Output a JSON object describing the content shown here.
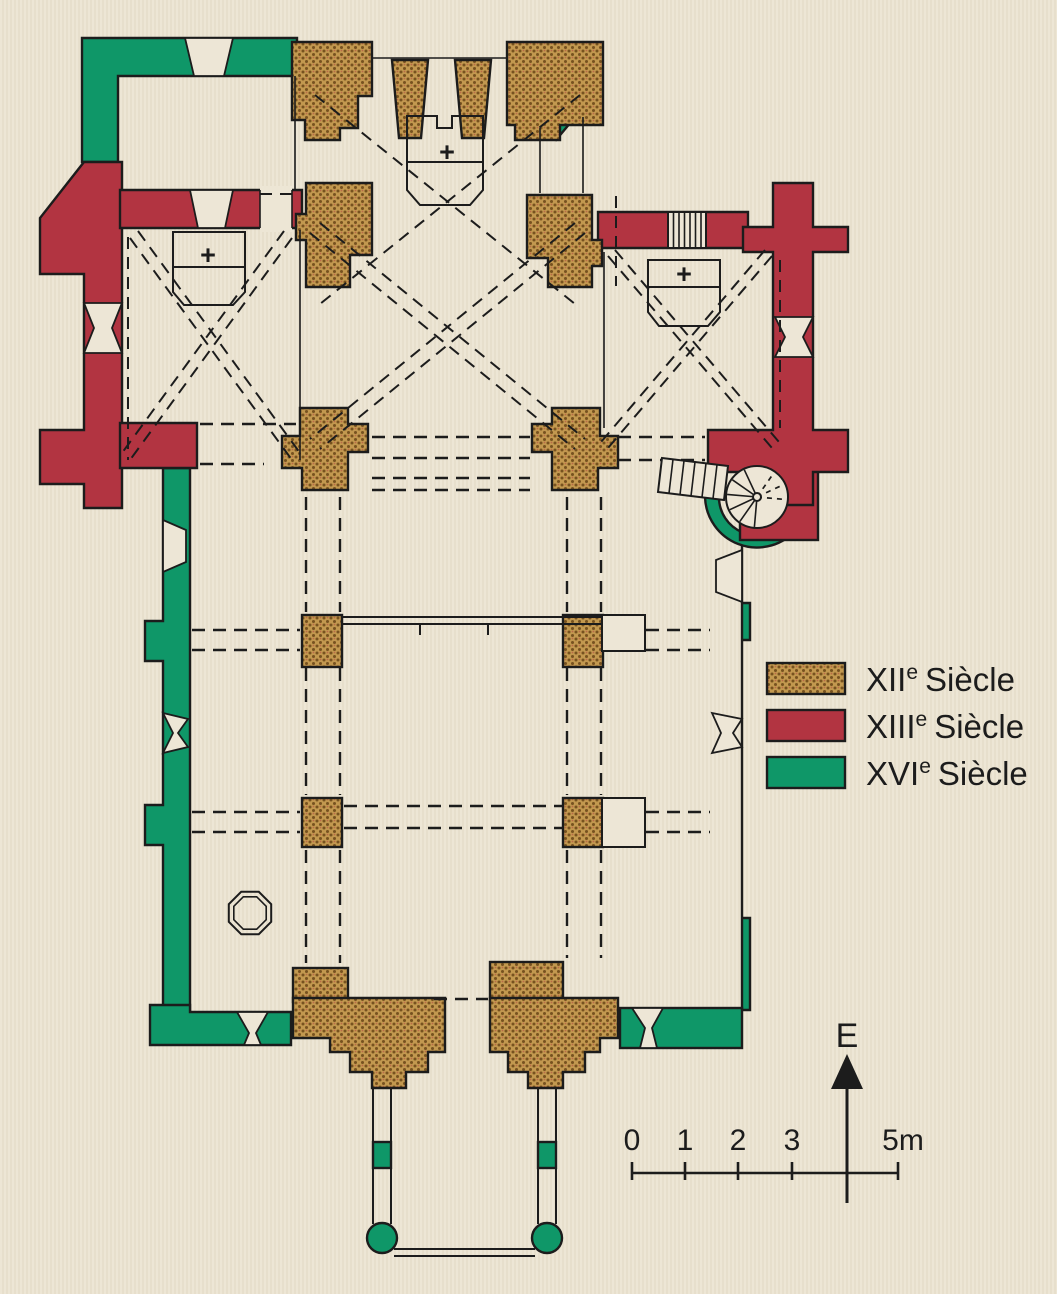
{
  "figure": {
    "type": "architectural floor plan",
    "subject": "Church plan with construction phases by century",
    "altar_count": 3
  },
  "colors": {
    "background": "#EDE6D5",
    "background_stripe": "#E7DFCC",
    "room": "#EDE6D6",
    "line": "#1C1C1C",
    "text": "#1C1C1C",
    "xii_brown": "#A07A3C",
    "xii_brown_light": "#C2984F",
    "xii_brown_dark": "#77521F",
    "xiii_red": "#B23441",
    "xvi_green": "#0F9768"
  },
  "legend": {
    "items": [
      {
        "numeral": "XII",
        "sup": "e",
        "word": "Siècle",
        "color": "#A07A3C",
        "texture": "dotted"
      },
      {
        "numeral": "XIII",
        "sup": "e",
        "word": "Siècle",
        "color": "#B23441",
        "texture": "solid"
      },
      {
        "numeral": "XVI",
        "sup": "e",
        "word": "Siècle",
        "color": "#0F9768",
        "texture": "solid"
      }
    ]
  },
  "compass": {
    "label": "E"
  },
  "scale_bar": {
    "tick_labels": [
      "0",
      "1",
      "2",
      "3"
    ],
    "end_label": "5m",
    "unit": "m",
    "total_meters": 5
  },
  "plan": {
    "altar_symbol": "+"
  }
}
